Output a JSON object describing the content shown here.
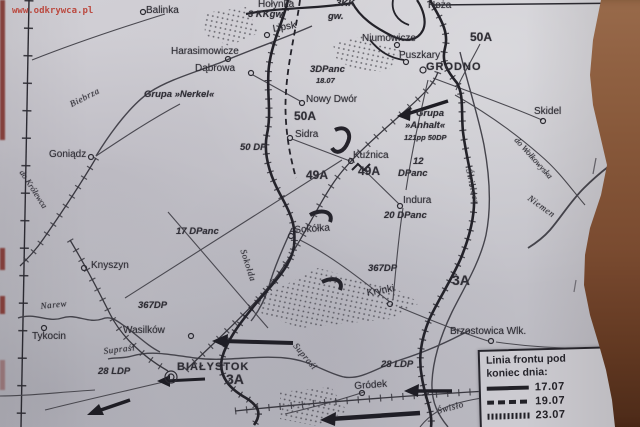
{
  "watermark": {
    "text": "www.odkrywca.pl"
  },
  "legend": {
    "title_line1": "Linia frontu pod",
    "title_line2": "koniec dnia:",
    "entries": [
      {
        "date": "17.07",
        "style": "solid"
      },
      {
        "date": "19.07",
        "style": "dashed"
      },
      {
        "date": "23.07",
        "style": "hatched"
      }
    ]
  },
  "colors": {
    "paper": "#c8c6cc",
    "ink": "#2f2e35",
    "watermark_red": "#c03a2e",
    "table_brown": "#8a5738",
    "edge_mark_red": "#7e2a24"
  },
  "labels": [
    {
      "text": "Balinka",
      "x": 146,
      "y": 5,
      "cls": "town"
    },
    {
      "text": "Hołynka",
      "x": 258,
      "y": -1,
      "cls": "town"
    },
    {
      "text": "3KK",
      "x": 336,
      "y": -2,
      "cls": "unit"
    },
    {
      "text": "3 KKgw.",
      "x": 248,
      "y": 9,
      "cls": "unit"
    },
    {
      "text": "gw.",
      "x": 328,
      "y": 11,
      "cls": "unit"
    },
    {
      "text": "Lipsk",
      "x": 272,
      "y": 24,
      "cls": "town",
      "rot": -10
    },
    {
      "text": "Niumowicze",
      "x": 362,
      "y": 33,
      "cls": "town"
    },
    {
      "text": "Hoża",
      "x": 428,
      "y": 0,
      "cls": "town"
    },
    {
      "text": "50A",
      "x": 470,
      "y": 30,
      "cls": "army"
    },
    {
      "text": "Puszkary",
      "x": 399,
      "y": 50,
      "cls": "town"
    },
    {
      "text": "GRODNO",
      "x": 426,
      "y": 61,
      "cls": "city"
    },
    {
      "text": "Skidel",
      "x": 534,
      "y": 106,
      "cls": "town"
    },
    {
      "text": "Harasimowicze",
      "x": 171,
      "y": 46,
      "cls": "town"
    },
    {
      "text": "Dąbrowa",
      "x": 195,
      "y": 63,
      "cls": "town"
    },
    {
      "text": "3DPanc",
      "x": 310,
      "y": 64,
      "cls": "unit"
    },
    {
      "text": "18.07",
      "x": 316,
      "y": 76,
      "cls": "unit-sm"
    },
    {
      "text": "Grupa »Nerkel«",
      "x": 144,
      "y": 89,
      "cls": "unit"
    },
    {
      "text": "Nowy Dwór",
      "x": 306,
      "y": 94,
      "cls": "town"
    },
    {
      "text": "50A",
      "x": 294,
      "y": 109,
      "cls": "army"
    },
    {
      "text": "Grupa",
      "x": 416,
      "y": 108,
      "cls": "unit"
    },
    {
      "text": "»Anhalt«",
      "x": 405,
      "y": 120,
      "cls": "unit"
    },
    {
      "text": "121pp 50DP",
      "x": 404,
      "y": 133,
      "cls": "unit-sm"
    },
    {
      "text": "Sidra",
      "x": 295,
      "y": 129,
      "cls": "town"
    },
    {
      "text": "50 DP",
      "x": 240,
      "y": 142,
      "cls": "unit"
    },
    {
      "text": "Kuźnica",
      "x": 353,
      "y": 150,
      "cls": "town"
    },
    {
      "text": "12",
      "x": 413,
      "y": 156,
      "cls": "unit"
    },
    {
      "text": "DPanc",
      "x": 398,
      "y": 168,
      "cls": "unit"
    },
    {
      "text": "49A",
      "x": 358,
      "y": 164,
      "cls": "army"
    },
    {
      "text": "49A",
      "x": 306,
      "y": 168,
      "cls": "army"
    },
    {
      "text": "Indura",
      "x": 403,
      "y": 195,
      "cls": "town"
    },
    {
      "text": "20 DPanc",
      "x": 384,
      "y": 210,
      "cls": "unit"
    },
    {
      "text": "17 DPanc",
      "x": 176,
      "y": 226,
      "cls": "unit"
    },
    {
      "text": "Sokółka",
      "x": 294,
      "y": 225,
      "cls": "town",
      "rot": -4
    },
    {
      "text": "367DP",
      "x": 368,
      "y": 263,
      "cls": "unit"
    },
    {
      "text": "3A",
      "x": 452,
      "y": 272,
      "cls": "army-lg"
    },
    {
      "text": "Krynki",
      "x": 366,
      "y": 288,
      "cls": "town",
      "rot": -10
    },
    {
      "text": "Knyszyn",
      "x": 91,
      "y": 260,
      "cls": "town"
    },
    {
      "text": "Goniądz",
      "x": 49,
      "y": 149,
      "cls": "town"
    },
    {
      "text": "Brzostowica Wlk.",
      "x": 450,
      "y": 326,
      "cls": "town"
    },
    {
      "text": "Tykocin",
      "x": 32,
      "y": 331,
      "cls": "town"
    },
    {
      "text": "Wasilków",
      "x": 123,
      "y": 325,
      "cls": "town"
    },
    {
      "text": "367DP",
      "x": 138,
      "y": 300,
      "cls": "unit"
    },
    {
      "text": "28 LDP",
      "x": 98,
      "y": 366,
      "cls": "unit"
    },
    {
      "text": "BIAŁYSTOK",
      "x": 177,
      "y": 361,
      "cls": "city"
    },
    {
      "text": "3A",
      "x": 226,
      "y": 371,
      "cls": "army-lg"
    },
    {
      "text": "28 LDP",
      "x": 381,
      "y": 359,
      "cls": "unit"
    },
    {
      "text": "Gródek",
      "x": 354,
      "y": 381,
      "cls": "town",
      "rot": -4
    },
    {
      "text": "Biebrza",
      "x": 68,
      "y": 100,
      "cls": "river",
      "rot": -27
    },
    {
      "text": "Narew",
      "x": 40,
      "y": 301,
      "cls": "river",
      "rot": -6
    },
    {
      "text": "Supraśl",
      "x": 103,
      "y": 346,
      "cls": "river",
      "rot": -7
    },
    {
      "text": "Supraśl",
      "x": 299,
      "y": 341,
      "cls": "river",
      "rot": 50
    },
    {
      "text": "Sokołda",
      "x": 248,
      "y": 248,
      "cls": "river",
      "rot": 72
    },
    {
      "text": "Świsłocz",
      "x": 474,
      "y": 168,
      "cls": "river",
      "rot": 78
    },
    {
      "text": "Niemen",
      "x": 532,
      "y": 193,
      "cls": "river",
      "rot": 36
    },
    {
      "text": "Świsło",
      "x": 436,
      "y": 406,
      "cls": "river",
      "rot": -15
    },
    {
      "text": "do Wołkowyska",
      "x": 520,
      "y": 135,
      "cls": "roadlbl",
      "rot": 48
    },
    {
      "text": "do Królewca",
      "x": 26,
      "y": 168,
      "cls": "roadlbl",
      "rot": 57
    }
  ]
}
